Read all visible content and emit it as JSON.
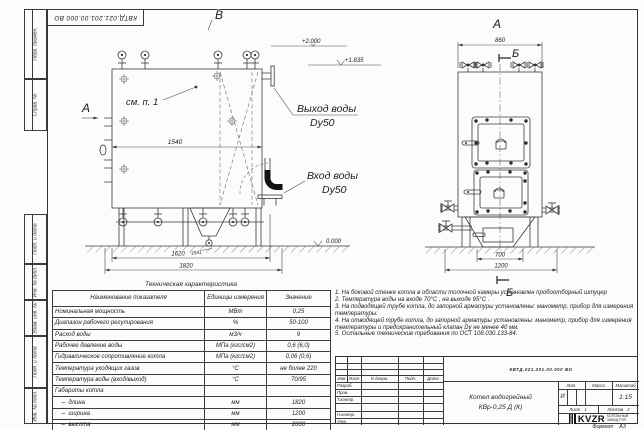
{
  "doc": {
    "number": "КВТД.021.201.00.000 ВО",
    "format_label": "Формат",
    "format_value": "А3"
  },
  "margin_labels": [
    "Перв. примен.",
    "Справ. №",
    "Подп. и дата",
    "Инв. № дубл.",
    "Взам. инв. №",
    "Подп. и дата",
    "Инв. № подл."
  ],
  "views": {
    "left": {
      "view_mark": "В",
      "dir_mark": "А",
      "see_note": "см. п. 1",
      "dim_body": "1540",
      "dim_struck": "1541",
      "dim_mid": "1620",
      "dim_total": "1820",
      "outlet_l1": "Выход воды",
      "outlet_l2": "Dy50",
      "inlet_l1": "Вход воды",
      "inlet_l2": "Dy50",
      "elev1": "+2.000",
      "elev2": "+1.835",
      "elev0": "0.000"
    },
    "right": {
      "view_mark": "А",
      "dim_width": "860",
      "section_mark_top": "Б",
      "section_mark_bottom": "Б",
      "dim_inner": "700",
      "dim_base": "1200"
    }
  },
  "tech_table": {
    "title": "Техническая характеристика",
    "col1": "Наименование показателя",
    "col2": "Единицы измерения",
    "col3": "Значение",
    "rows": [
      [
        "Номинальная мощность",
        "МВт",
        "0,25"
      ],
      [
        "Диапазон рабочего регулирования",
        "%",
        "50-100"
      ],
      [
        "Расход воды",
        "м3/ч",
        "9"
      ],
      [
        "Рабочее давление воды",
        "МПа (кгс/см2)",
        "0,6 (6,0)"
      ],
      [
        "Гидравлическое сопротивление котла",
        "МПа (кгс/см2)",
        "0,06 (0,6)"
      ],
      [
        "Температура уходящих газов",
        "°С",
        "не более 220"
      ],
      [
        "Температура воды (вход/выход)",
        "°С",
        "70/95"
      ],
      [
        "Габариты котла",
        "",
        ""
      ],
      [
        "    –  длина",
        "мм",
        "1820"
      ],
      [
        "    –  ширина",
        "мм",
        "1200"
      ],
      [
        "    –  высота",
        "мм",
        "2000"
      ]
    ]
  },
  "notes": [
    "1.  На боковой стенке котла в области топочной камеры установлен пробоотборный штуцер",
    "2.  Температура воды на входе  70°С , на выходе  95°С .",
    "3.  На подводящей трубе котла, до запорной арматуры установлены:  манометр, прибор для измерения температуры.",
    "4.  На отводящей трубе котла, до запорной арматуры установлены:  манометр, прибор для измерения температуры и предохранительный клапан  Dy не менее  40 мм.",
    "5.  Остальные технические требования по ОСТ  108.030.133-84."
  ],
  "title_block": {
    "doc_number": "КВТД.021.201.00.000  ВО",
    "rev_cols": [
      "Изм",
      "Лист",
      "N докум.",
      "Подп.",
      "Дата"
    ],
    "rows": [
      "Разраб.",
      "Пров.",
      "Т.контр.",
      "",
      "Н.контр.",
      "Утв."
    ],
    "product_line1": "Котел водогрейный",
    "product_line2": "КВр-0,25 Д (К)",
    "lit_label": "Лит.",
    "mass_label": "Масса",
    "scale_label": "Масштаб",
    "lit_value": "И",
    "scale_value": "1:15",
    "sheet_label": "Лист",
    "sheet_value": "1",
    "sheets_label": "Листов",
    "sheets_value": "2",
    "logo": "KVZR",
    "logo_line1": "КОТЕЛЬНЫЙ",
    "logo_line2": "ЗАВОД РЭП"
  }
}
